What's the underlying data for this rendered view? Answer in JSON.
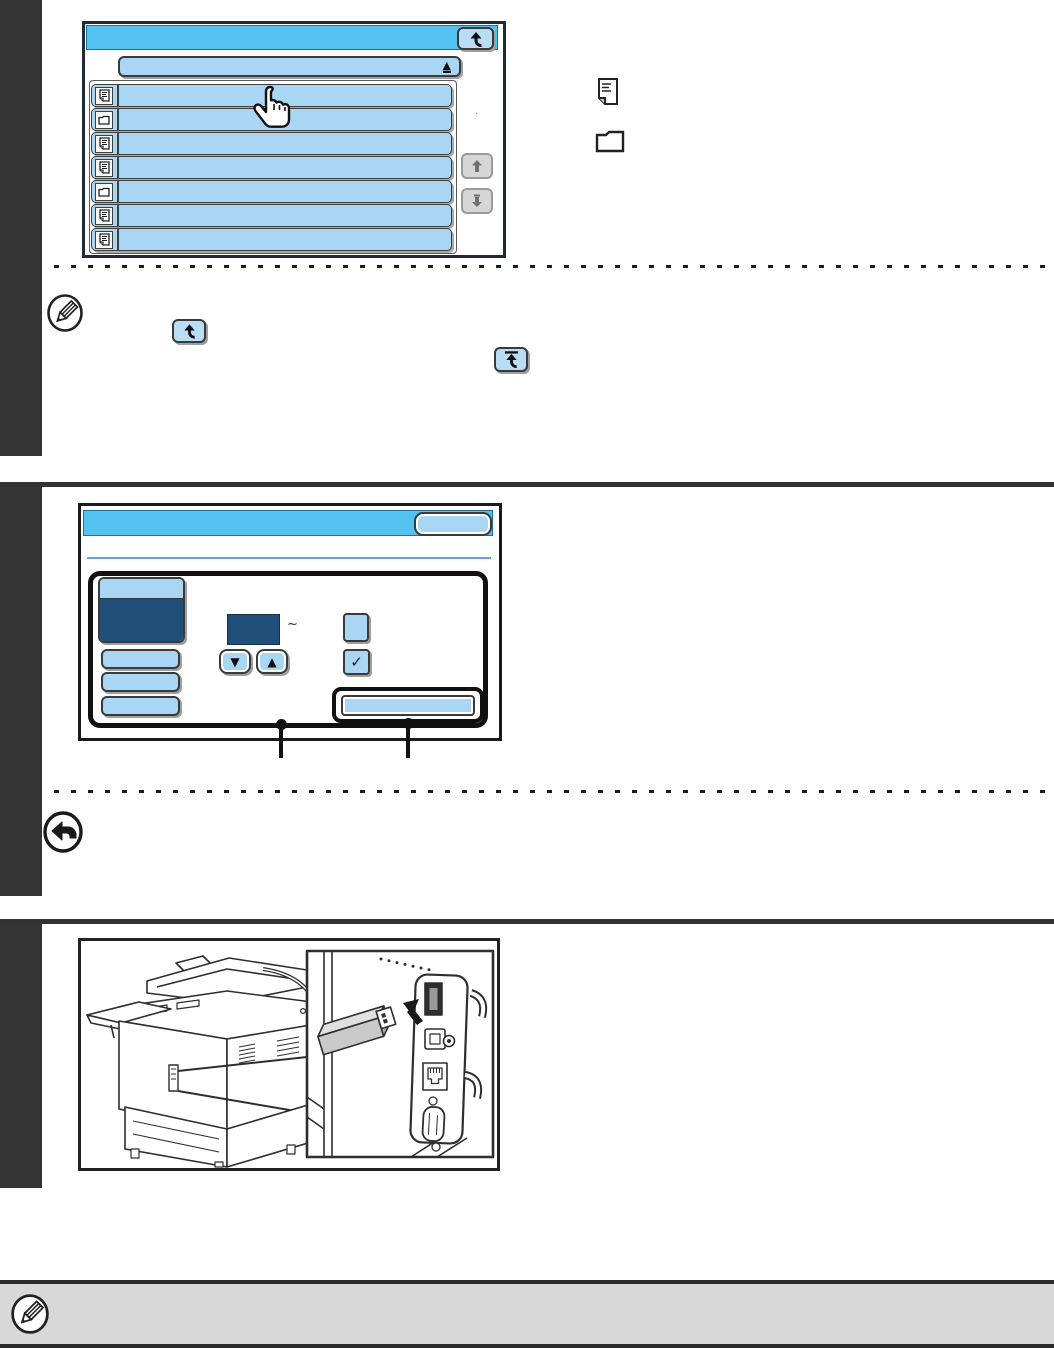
{
  "colors": {
    "sidebar_black": "#343434",
    "titlebar_blue": "#54c2f0",
    "key_blue": "#a9d6f2",
    "key_blue_light": "#b9ddf4",
    "dark_navy": "#1f4e79",
    "scroll_gray": "#d6d6d6",
    "note_bar_gray": "#d8d8d8"
  },
  "screen1": {
    "description": "file/folder selection touch screen",
    "back_key_icon": "folder-up-arrow",
    "sort_glyph": "▲",
    "rows": [
      {
        "icon": "document"
      },
      {
        "icon": "folder"
      },
      {
        "icon": "document"
      },
      {
        "icon": "document"
      },
      {
        "icon": "folder"
      },
      {
        "icon": "document"
      },
      {
        "icon": "document"
      }
    ],
    "scroll_keys": [
      "scroll-up",
      "scroll-down"
    ],
    "cursor": "pointing-hand",
    "stray_mark": "."
  },
  "legend_icons": [
    {
      "name": "document-icon"
    },
    {
      "name": "folder-icon"
    }
  ],
  "note1": {
    "icon": "pencil-note",
    "inline_keys": [
      {
        "icon": "folder-up-arrow"
      },
      {
        "icon": "folder-up-arrow-with-bar"
      }
    ]
  },
  "screen2": {
    "description": "setting screen with number display and checkbox",
    "ok_key": "",
    "tilde": "~",
    "down_glyph": "▼",
    "up_glyph": "▲",
    "check_glyph": "✓"
  },
  "note2": {
    "icon": "back-arrow"
  },
  "illustration": {
    "subject": "multifunction printer with USB memory being inserted into USB connector",
    "parts": [
      "printer",
      "usb-memory",
      "usb-port",
      "usb-b-port",
      "ethernet-port",
      "serial-port",
      "cable-hooks"
    ]
  }
}
